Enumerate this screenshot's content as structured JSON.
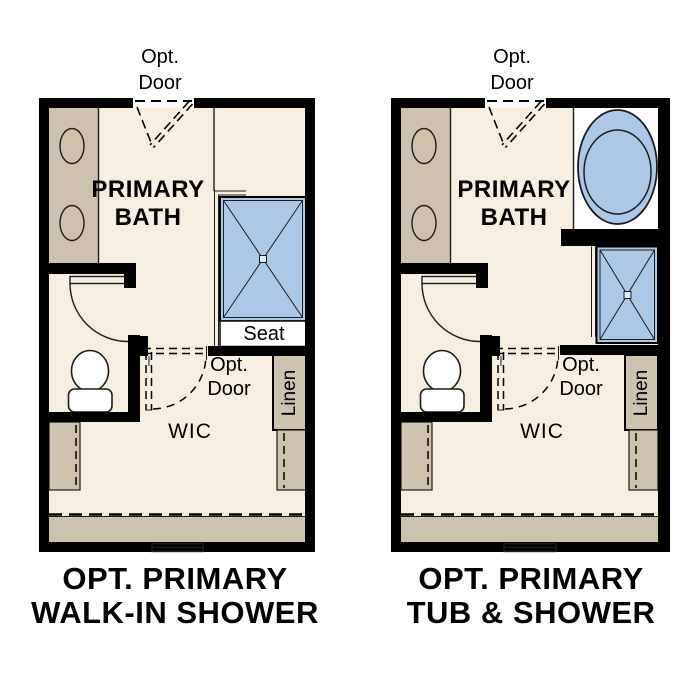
{
  "colors": {
    "background": "#ffffff",
    "floor": "#f5eee1",
    "cabinet_tan": "#cdc2ab",
    "fixture_blue": "#abc9e7",
    "wall": "#000000",
    "text": "#000000"
  },
  "plans": [
    {
      "name": "walk-in-shower-option",
      "opt_door_top": {
        "line1": "Opt.",
        "line2": "Door"
      },
      "room": {
        "line1": "PRIMARY",
        "line2": "BATH"
      },
      "seat_label": "Seat",
      "opt_door_wic": {
        "line1": "Opt.",
        "line2": "Door"
      },
      "wic_label": "WIC",
      "linen_label": "Linen",
      "title": {
        "line1": "OPT. PRIMARY",
        "line2": "WALK-IN SHOWER"
      }
    },
    {
      "name": "tub-and-shower-option",
      "opt_door_top": {
        "line1": "Opt.",
        "line2": "Door"
      },
      "room": {
        "line1": "PRIMARY",
        "line2": "BATH"
      },
      "opt_door_wic": {
        "line1": "Opt.",
        "line2": "Door"
      },
      "wic_label": "WIC",
      "linen_label": "Linen",
      "title": {
        "line1": "OPT. PRIMARY",
        "line2": "TUB & SHOWER"
      }
    }
  ]
}
